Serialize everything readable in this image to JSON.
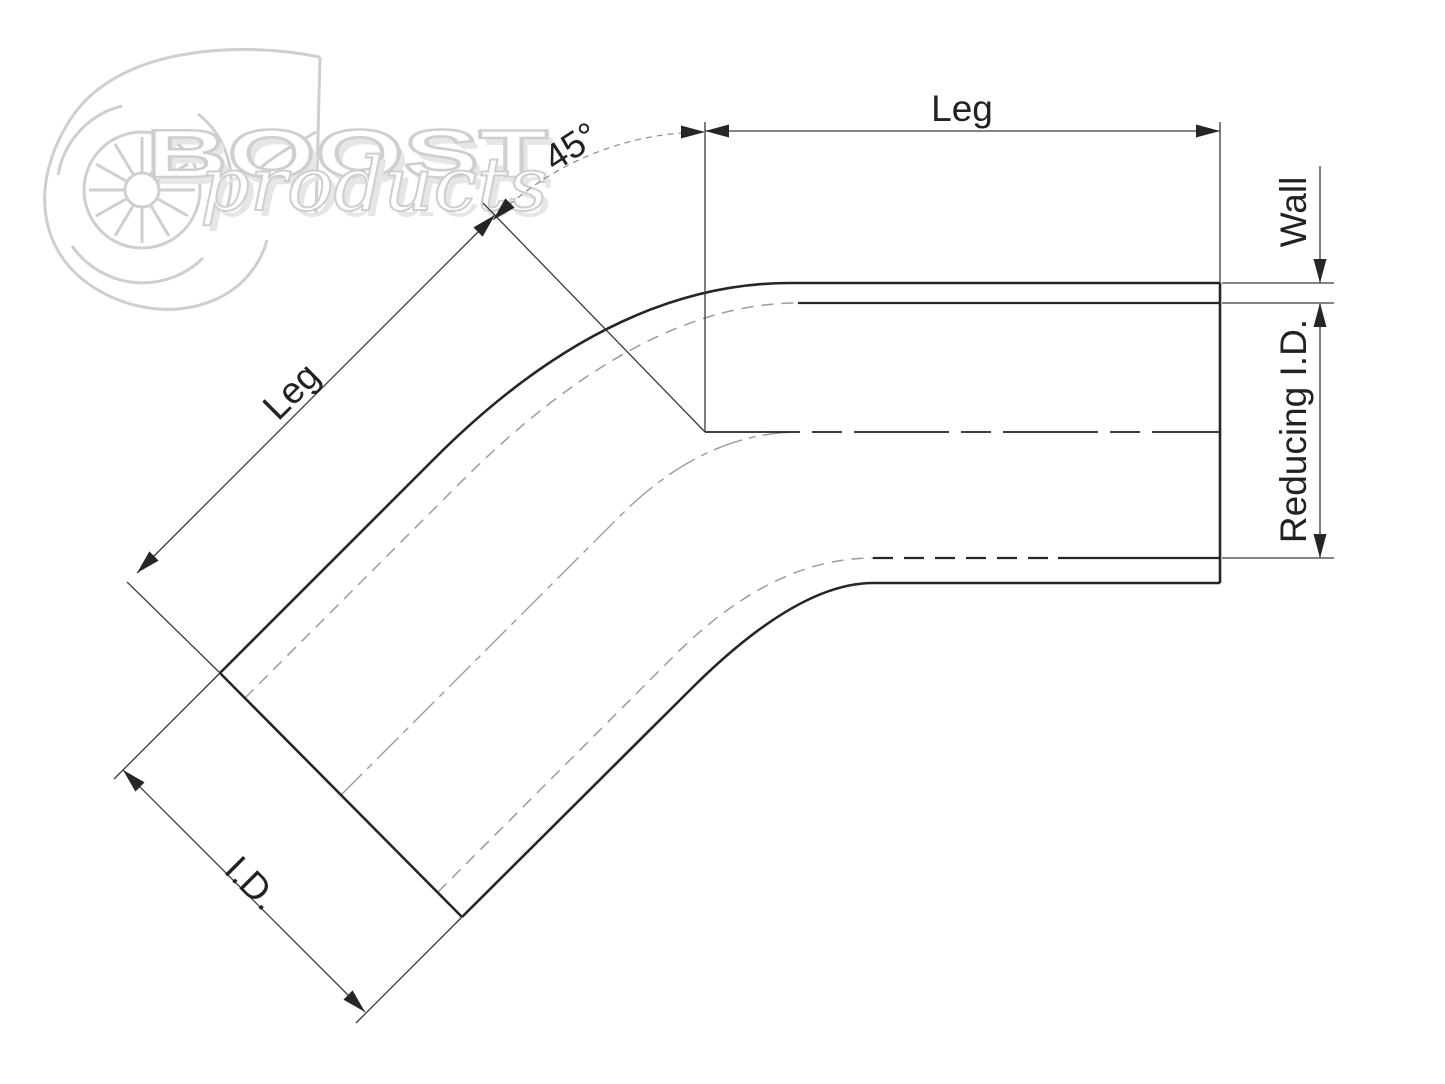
{
  "diagram": {
    "type": "technical-drawing",
    "subject": "45-degree reducing elbow with dimension callouts",
    "angle_value": "45°",
    "labels": {
      "leg_top": "Leg",
      "leg_diagonal": "Leg",
      "angle": "45°",
      "wall": "Wall",
      "reducing_id": "Reducing I.D.",
      "id": "I.D."
    }
  },
  "watermark": {
    "brand": "BOOST",
    "subbrand": "products"
  },
  "colors": {
    "background": "#ffffff",
    "outline": "#262626",
    "dimension": "#3a3a3a",
    "hidden": "#9c9c9c",
    "arc": "#8a8a8a",
    "text": "#222222",
    "watermark": "#cfcfcf"
  }
}
